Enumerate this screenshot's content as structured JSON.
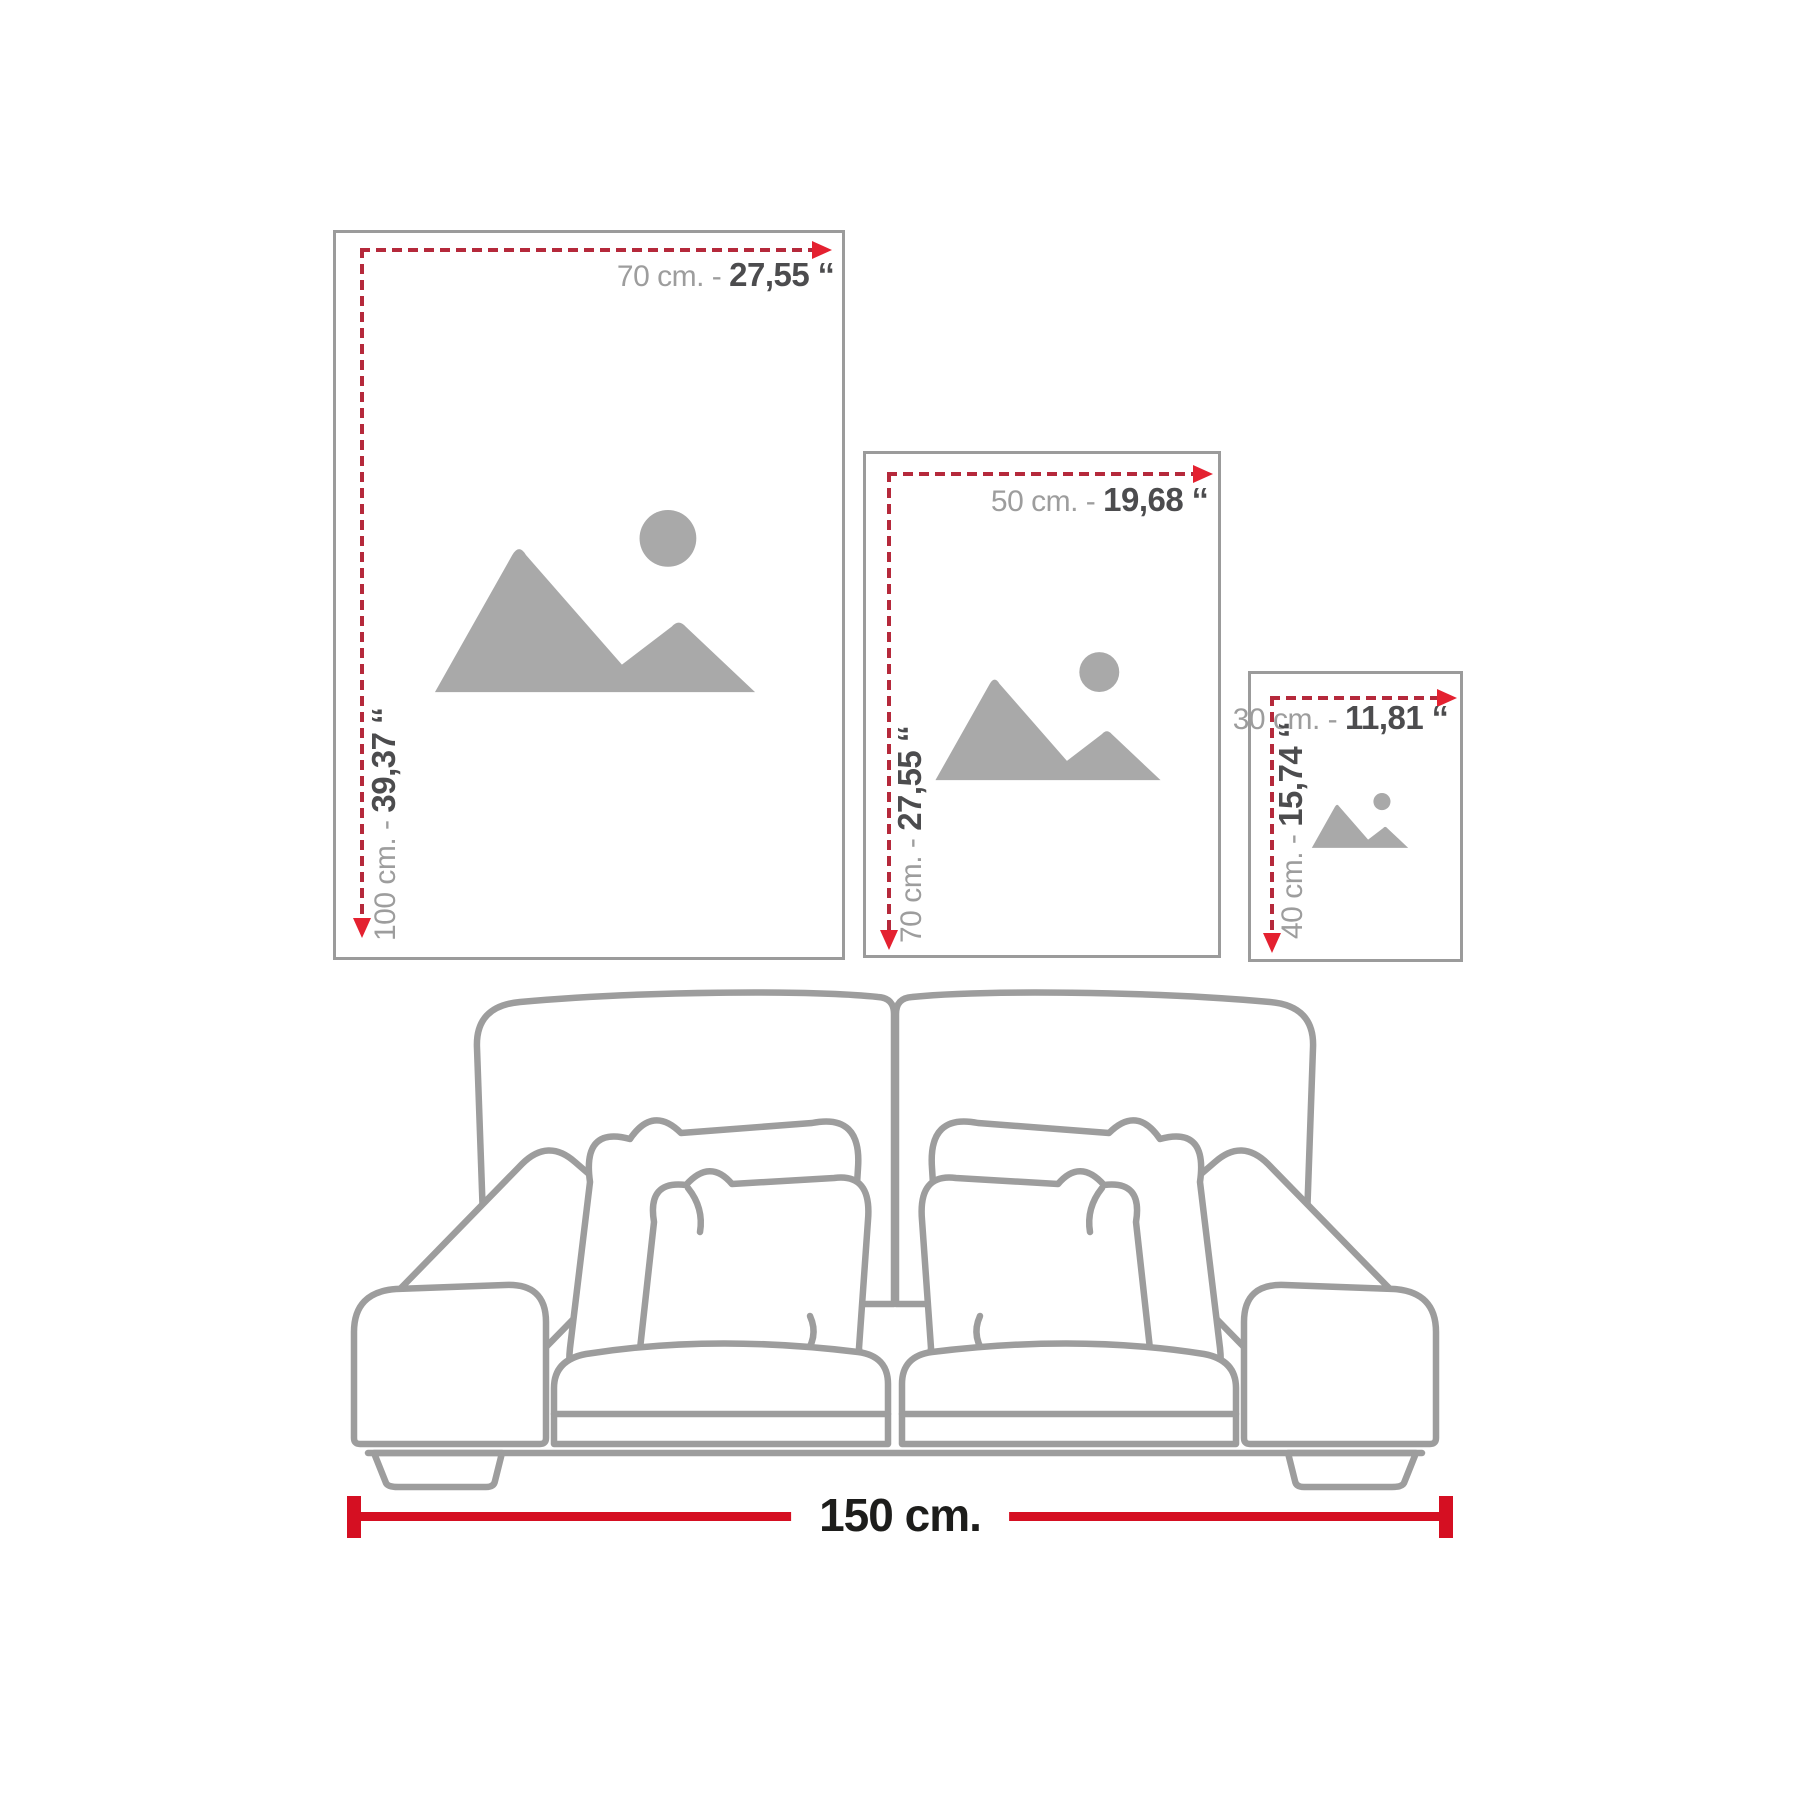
{
  "colors": {
    "frame_border": "#9b9b9b",
    "placeholder_gray": "#a9a9a9",
    "label_light_gray": "#9d9d9d",
    "label_dark_gray": "#4c4c4e",
    "dash_red": "#b5293b",
    "arrow_red": "#e42130",
    "measure_red": "#d50f22",
    "measure_text": "#1d1d1b",
    "sofa_line": "#9d9d9d"
  },
  "frames": [
    {
      "width_cm": "70 cm. - ",
      "width_in": "27,55 ‘‘",
      "height_cm": "100 cm. - ",
      "height_in": "39,37 ‘‘"
    },
    {
      "width_cm": "50 cm. - ",
      "width_in": "19,68 ‘‘",
      "height_cm": "70 cm. - ",
      "height_in": "27,55 ‘‘"
    },
    {
      "width_cm": "30 cm. - ",
      "width_in": "11,81 ‘‘",
      "height_cm": "40 cm. - ",
      "height_in": "15,74 ‘‘"
    }
  ],
  "sofa": {
    "width_label": "150 cm."
  }
}
